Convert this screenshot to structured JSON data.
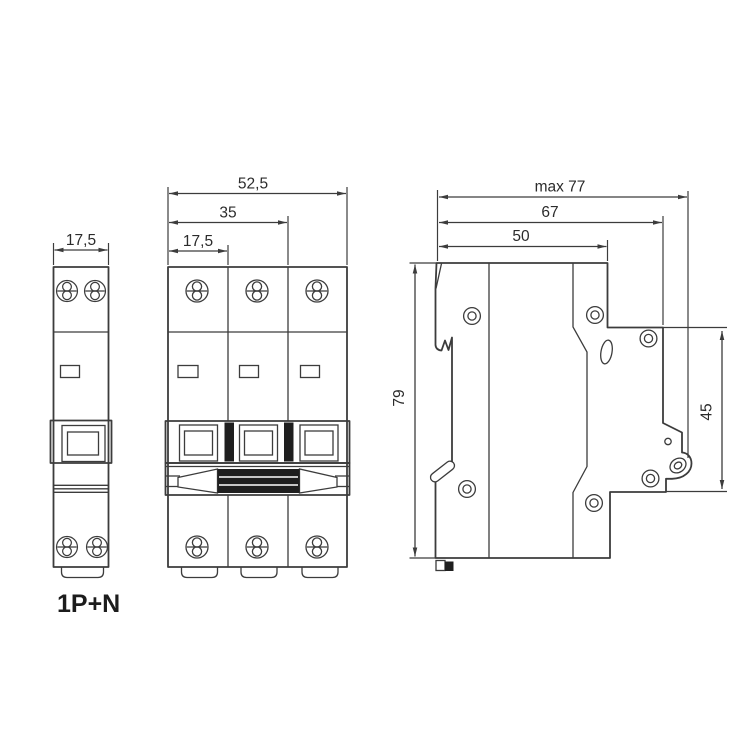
{
  "colors": {
    "line": "#3c3c3c",
    "text": "#2b2b2b",
    "dark_fill": "#1f1f1f",
    "background": "#ffffff"
  },
  "views": {
    "front_1pn": {
      "caption": "1P+N",
      "dim_width": "17,5"
    },
    "front_3p": {
      "dim_total_width": "52,5",
      "dim_two_poles": "35",
      "dim_one_pole": "17,5"
    },
    "side": {
      "dim_max_depth": "max 77",
      "dim_depth_upper": "67",
      "dim_depth_top": "50",
      "dim_height": "79",
      "dim_front_height": "45"
    }
  }
}
